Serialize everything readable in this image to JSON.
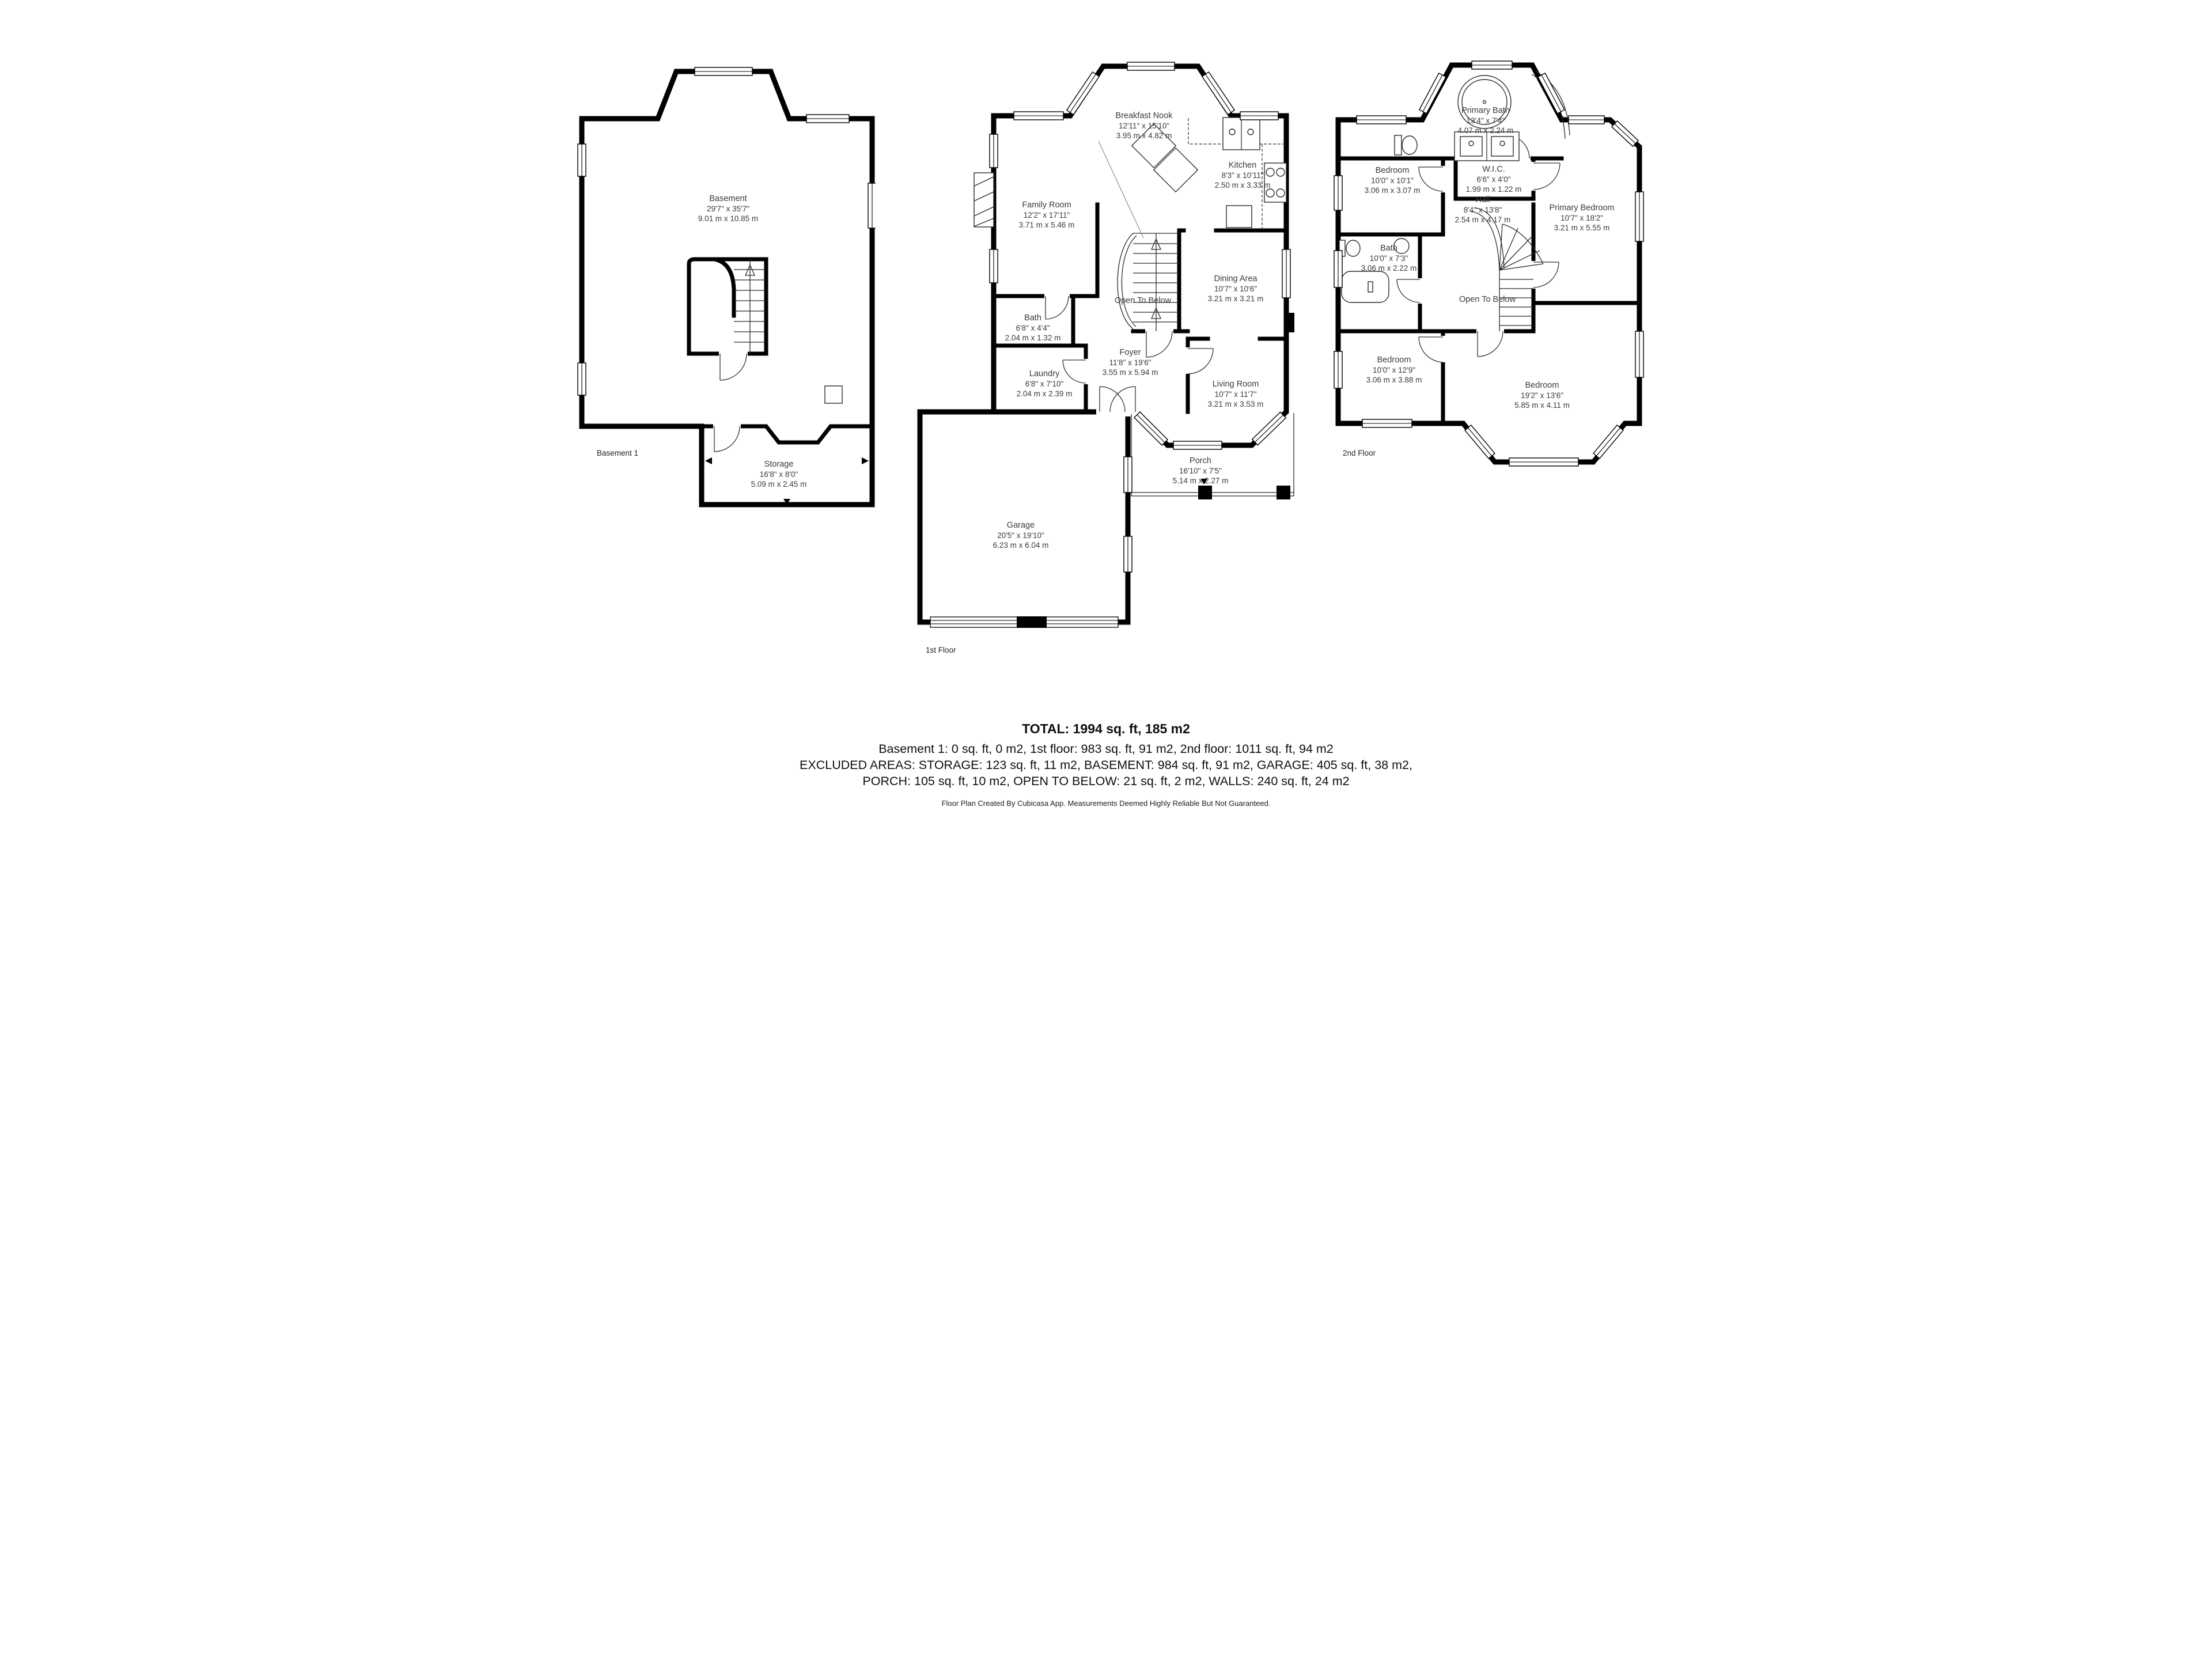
{
  "colors": {
    "walls": "#000000",
    "label_text": "#3a3a3a",
    "background": "#ffffff"
  },
  "floors": [
    {
      "name": "Basement 1",
      "rooms": [
        {
          "name": "Basement",
          "imperial": "29'7\" x 35'7\"",
          "metric": "9.01 m x 10.85 m"
        },
        {
          "name": "Storage",
          "imperial": "16'8\" x 8'0\"",
          "metric": "5.09 m x 2.45 m"
        }
      ]
    },
    {
      "name": "1st Floor",
      "rooms": [
        {
          "name": "Breakfast Nook",
          "imperial": "12'11\" x 15'10\"",
          "metric": "3.95 m x 4.82 m"
        },
        {
          "name": "Kitchen",
          "imperial": "8'3\" x 10'11\"",
          "metric": "2.50 m x 3.33 m"
        },
        {
          "name": "Family Room",
          "imperial": "12'2\" x 17'11\"",
          "metric": "3.71 m x 5.46 m"
        },
        {
          "name": "Dining Area",
          "imperial": "10'7\" x 10'6\"",
          "metric": "3.21 m x 3.21 m"
        },
        {
          "name": "Open To Below"
        },
        {
          "name": "Bath",
          "imperial": "6'8\" x 4'4\"",
          "metric": "2.04 m x 1.32 m"
        },
        {
          "name": "Foyer",
          "imperial": "11'8\" x 19'6\"",
          "metric": "3.55 m x 5.94 m"
        },
        {
          "name": "Laundry",
          "imperial": "6'8\" x 7'10\"",
          "metric": "2.04 m x 2.39 m"
        },
        {
          "name": "Living Room",
          "imperial": "10'7\" x 11'7\"",
          "metric": "3.21 m x 3.53 m"
        },
        {
          "name": "Porch",
          "imperial": "16'10\" x 7'5\"",
          "metric": "5.14 m x 2.27 m"
        },
        {
          "name": "Garage",
          "imperial": "20'5\" x 19'10\"",
          "metric": "6.23 m x 6.04 m"
        }
      ]
    },
    {
      "name": "2nd Floor",
      "rooms": [
        {
          "name": "Primary Bath",
          "imperial": "13'4\" x 7'4\"",
          "metric": "4.07 m x 2.24 m"
        },
        {
          "name": "Bedroom",
          "imperial": "10'0\" x 10'1\"",
          "metric": "3.06 m x 3.07 m"
        },
        {
          "name": "W.I.C.",
          "imperial": "6'6\" x 4'0\"",
          "metric": "1.99 m x 1.22 m"
        },
        {
          "name": "Hall",
          "imperial": "8'4\" x 13'8\"",
          "metric": "2.54 m x 4.17 m"
        },
        {
          "name": "Primary Bedroom",
          "imperial": "10'7\" x 18'2\"",
          "metric": "3.21 m x 5.55 m"
        },
        {
          "name": "Bath",
          "imperial": "10'0\" x 7'3\"",
          "metric": "3.06 m x 2.22 m"
        },
        {
          "name": "Open To Below"
        },
        {
          "name": "Bedroom",
          "imperial": "10'0\" x 12'9\"",
          "metric": "3.06 m x 3.88 m"
        },
        {
          "name": "Bedroom",
          "imperial": "19'2\" x 13'6\"",
          "metric": "5.85 m x 4.11 m"
        }
      ]
    }
  ],
  "summary": {
    "total": "TOTAL: 1994 sq. ft, 185 m2",
    "floors_line": "Basement 1: 0 sq. ft, 0 m2, 1st floor: 983 sq. ft, 91 m2, 2nd floor: 1011 sq. ft, 94 m2",
    "excluded_line_1": "EXCLUDED AREAS: STORAGE: 123 sq. ft, 11 m2, BASEMENT: 984 sq. ft, 91 m2, GARAGE: 405 sq. ft, 38 m2,",
    "excluded_line_2": "PORCH: 105 sq. ft, 10 m2, OPEN TO BELOW: 21 sq. ft, 2 m2, WALLS: 240 sq. ft, 24 m2",
    "disclaimer": "Floor Plan Created By Cubicasa App. Measurements Deemed Highly Reliable But Not Guaranteed."
  }
}
